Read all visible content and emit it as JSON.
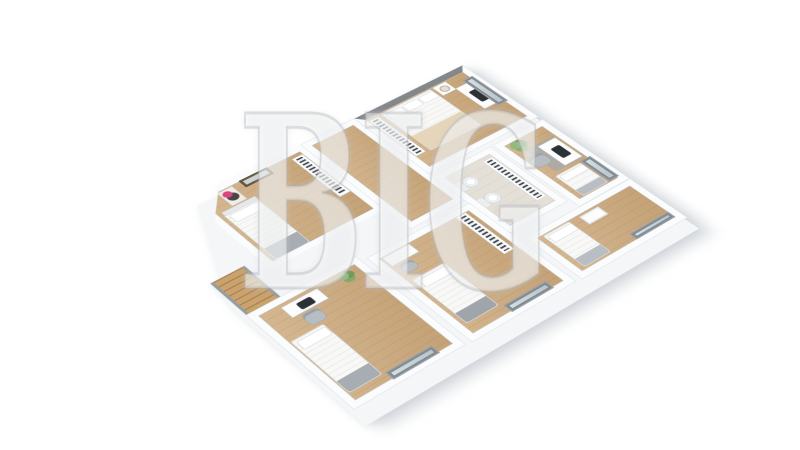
{
  "image_type": "3d-floor-plan-rendering",
  "background_color": "#ffffff",
  "watermark": {
    "text": "BIG"
  },
  "palette": {
    "wood_floor": "#cdab7f",
    "wall": "#fbfcfd",
    "wall_edge": "#e2e6e9",
    "accent_wall_gray": "#85888b",
    "window_frame": "#828a91",
    "window_glass": "#cfdade",
    "bookshelf_books": "#464b51",
    "bedding_white": "#f8f8f6",
    "throw_beige": "#e5d5ba",
    "textile_gray": "#a7adb3",
    "plant_green": "#7da367",
    "bathroom_floor": "#e4dfd7",
    "monitor_dark": "#2c3135",
    "stair_wood": "#c9a26d",
    "art_pink": "#d6467e",
    "mirror_frame": "#6b5a3e"
  },
  "scene": {
    "style": "isometric-style 3D render of an upper-storey floor plan, cut-away walls, white background",
    "rooms": [
      {
        "id": "bedroom-1",
        "area": "upper-left",
        "floor": "wood",
        "furniture": [
          "single bed with gray throw",
          "portrait artwork with pink accent",
          "gold-framed wall mirror",
          "bookshelf"
        ]
      },
      {
        "id": "hallway",
        "area": "center",
        "floor": "wood",
        "furniture": [
          "staircase"
        ]
      },
      {
        "id": "bedroom-2",
        "area": "top-center",
        "floor": "wood",
        "furniture": [
          "double bed with beige throw",
          "gray accent wall",
          "nightstand with lamp",
          "bookshelf",
          "desk with monitor",
          "window"
        ]
      },
      {
        "id": "bathroom",
        "area": "center",
        "floor": "tile",
        "furniture": [
          "toilet",
          "bidet",
          "bookshelf"
        ]
      },
      {
        "id": "bedroom-3",
        "area": "right",
        "floor": "wood",
        "furniture": [
          "potted plant",
          "gray rug",
          "desk with monitor",
          "office chair",
          "single bed",
          "window"
        ]
      },
      {
        "id": "bedroom-4",
        "area": "lower-left",
        "floor": "wood",
        "furniture": [
          "desk with monitor",
          "chair",
          "potted plant",
          "single bed with gray throw",
          "window"
        ]
      },
      {
        "id": "bedroom-5",
        "area": "bottom-center",
        "floor": "wood",
        "furniture": [
          "desk",
          "chair",
          "bookshelf",
          "single bed",
          "window"
        ]
      },
      {
        "id": "bedroom-6",
        "area": "bottom-right",
        "floor": "wood",
        "furniture": [
          "single bed",
          "dresser",
          "window"
        ]
      }
    ]
  }
}
